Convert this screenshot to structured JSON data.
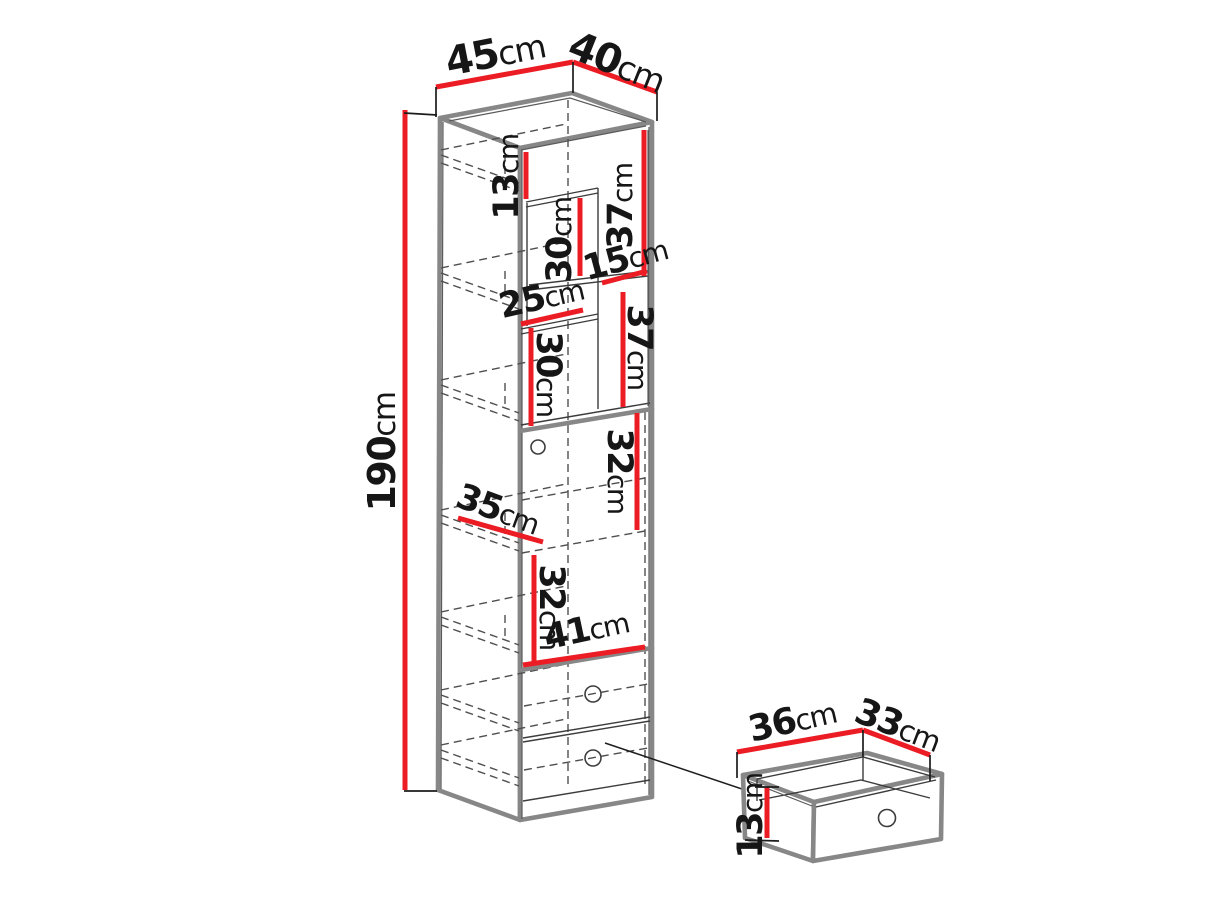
{
  "diagram": {
    "type": "furniture-dimension-drawing",
    "colors": {
      "dimension_line": "#ec1c24",
      "outline": "#878787",
      "detail_line": "#3c3c3c",
      "background": "#ffffff"
    },
    "dims": {
      "cabinet_width": {
        "v": "45",
        "u": "cm"
      },
      "cabinet_depth": {
        "v": "40",
        "u": "cm"
      },
      "cabinet_height": {
        "v": "190",
        "u": "cm"
      },
      "top_gap": {
        "v": "13",
        "u": "cm"
      },
      "upper_mid_height": {
        "v": "30",
        "u": "cm"
      },
      "upper_right_height": {
        "v": "37",
        "u": "cm"
      },
      "right_shelf_width": {
        "v": "15",
        "u": "cm"
      },
      "left_shelf_width": {
        "v": "25",
        "u": "cm"
      },
      "lower_left_height": {
        "v": "30",
        "u": "cm"
      },
      "lower_right_height": {
        "v": "37",
        "u": "cm"
      },
      "door_upper_height": {
        "v": "32",
        "u": "cm"
      },
      "shelf_depth": {
        "v": "35",
        "u": "cm"
      },
      "door_lower_height": {
        "v": "32",
        "u": "cm"
      },
      "interior_width": {
        "v": "41",
        "u": "cm"
      },
      "drawer_width": {
        "v": "36",
        "u": "cm"
      },
      "drawer_depth": {
        "v": "33",
        "u": "cm"
      },
      "drawer_height": {
        "v": "13",
        "u": "cm"
      }
    }
  }
}
